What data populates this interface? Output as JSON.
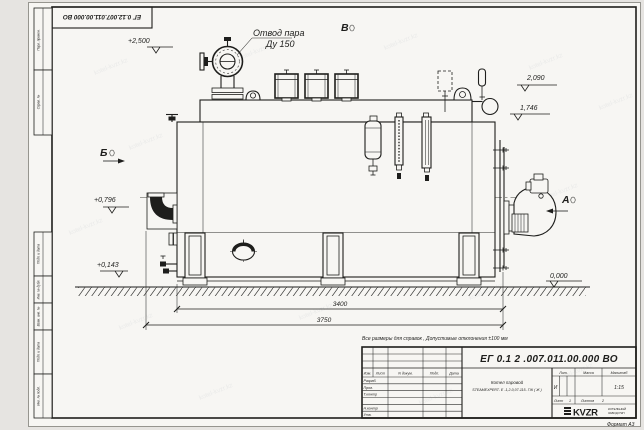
{
  "document": {
    "doc_number_top": "ЕГ 0.12.007.011.00.000  ВО",
    "format_label": "Формат А3"
  },
  "margin_stamps": {
    "labels": [
      "Перв. примен.",
      "Справ. №",
      "Подп. и дата",
      "Инв. № дубл.",
      "Взам. инв. №",
      "Подп. и дата",
      "Инв. № подл."
    ]
  },
  "annotations": {
    "steam_outlet": {
      "line1": "Отвод пара",
      "line2": "Ду 150"
    },
    "views": {
      "a": "А",
      "b": "Б",
      "v": "В"
    },
    "elevations": {
      "e2500": "+2,500",
      "e2090": "2,090",
      "e1746": "1,746",
      "e0796": "+0,796",
      "e0143": "+0,143",
      "e0000": "0,000"
    },
    "dimensions": {
      "d3400": "3400",
      "d3750": "3750"
    },
    "note": "Все размеры для справок , Допустимые отклонения ±100 мм"
  },
  "title_block": {
    "doc_number": "ЕГ 0.1 2 .007.011.00.000  ВО",
    "name_line1": "Котел паровой",
    "name_line2": "STEAMEXPERT- Е -1,2-0,07-115- ГЖ ( Ж )",
    "headers": {
      "lit": "Лит.",
      "mass": "Масса",
      "scale": "Масштаб"
    },
    "values": {
      "lit": "И",
      "scale": "1:15"
    },
    "sheet": {
      "label": "Лист",
      "value": "1",
      "of_label": "Листов",
      "of_value": "2"
    },
    "columns": [
      "Изм.",
      "Лист",
      "N докум.",
      "Подп.",
      "Дата"
    ],
    "sig_rows": [
      "Разраб.",
      "Пров.",
      "Т.контр",
      "",
      "Н.контр",
      "Утв."
    ],
    "logo": {
      "text": "KVZR",
      "sub1": "КОТЕЛЬНЫЙ",
      "sub2": "ЗАВОД РЭП"
    }
  },
  "watermark": "kotel-kvzr.kz"
}
